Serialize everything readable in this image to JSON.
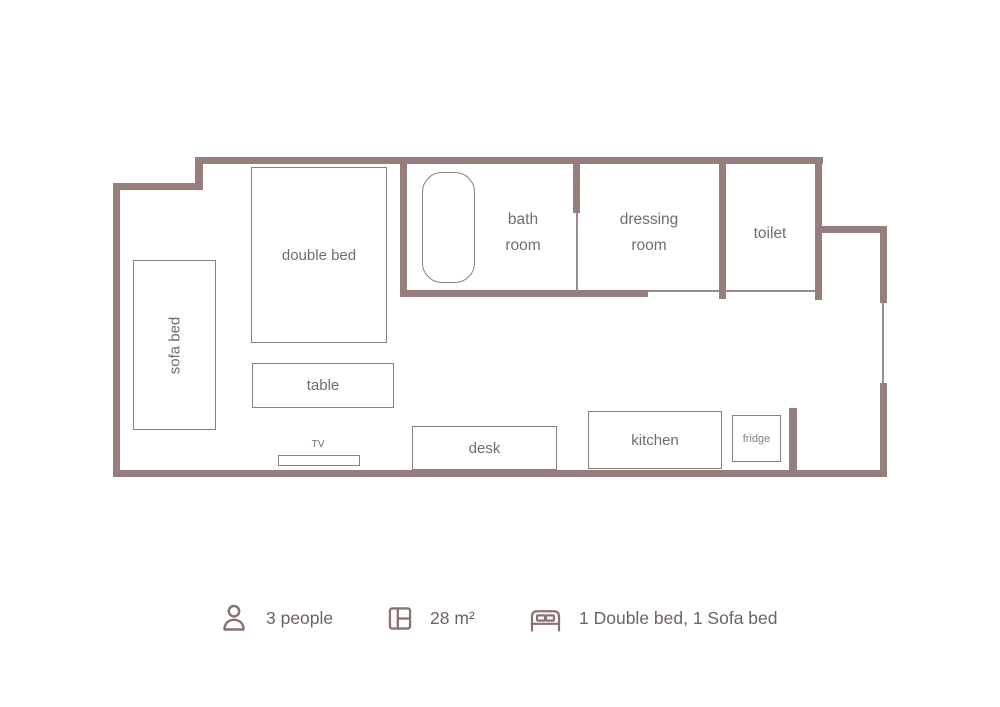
{
  "colors": {
    "wall": "#967e7c",
    "line": "#978a88",
    "furn": "#8c7e7c",
    "text": "#756b69",
    "legend_text": "#6d6361",
    "icon": "#8a7170"
  },
  "plan": {
    "furniture": {
      "sofa_bed": "sofa bed",
      "double_bed": "double bed",
      "table": "table",
      "tv": "TV",
      "desk": "desk",
      "kitchen": "kitchen",
      "fridge": "fridge"
    },
    "rooms": {
      "bath": [
        "bath",
        "room"
      ],
      "dressing": [
        "dressing",
        "room"
      ],
      "toilet": "toilet"
    }
  },
  "legend": {
    "capacity": {
      "icon": "person-icon",
      "label": "3 people"
    },
    "area": {
      "icon": "floorplan-icon",
      "label": "28 m²"
    },
    "beds": {
      "icon": "bed-icon",
      "label": "1 Double bed, 1 Sofa bed"
    }
  }
}
